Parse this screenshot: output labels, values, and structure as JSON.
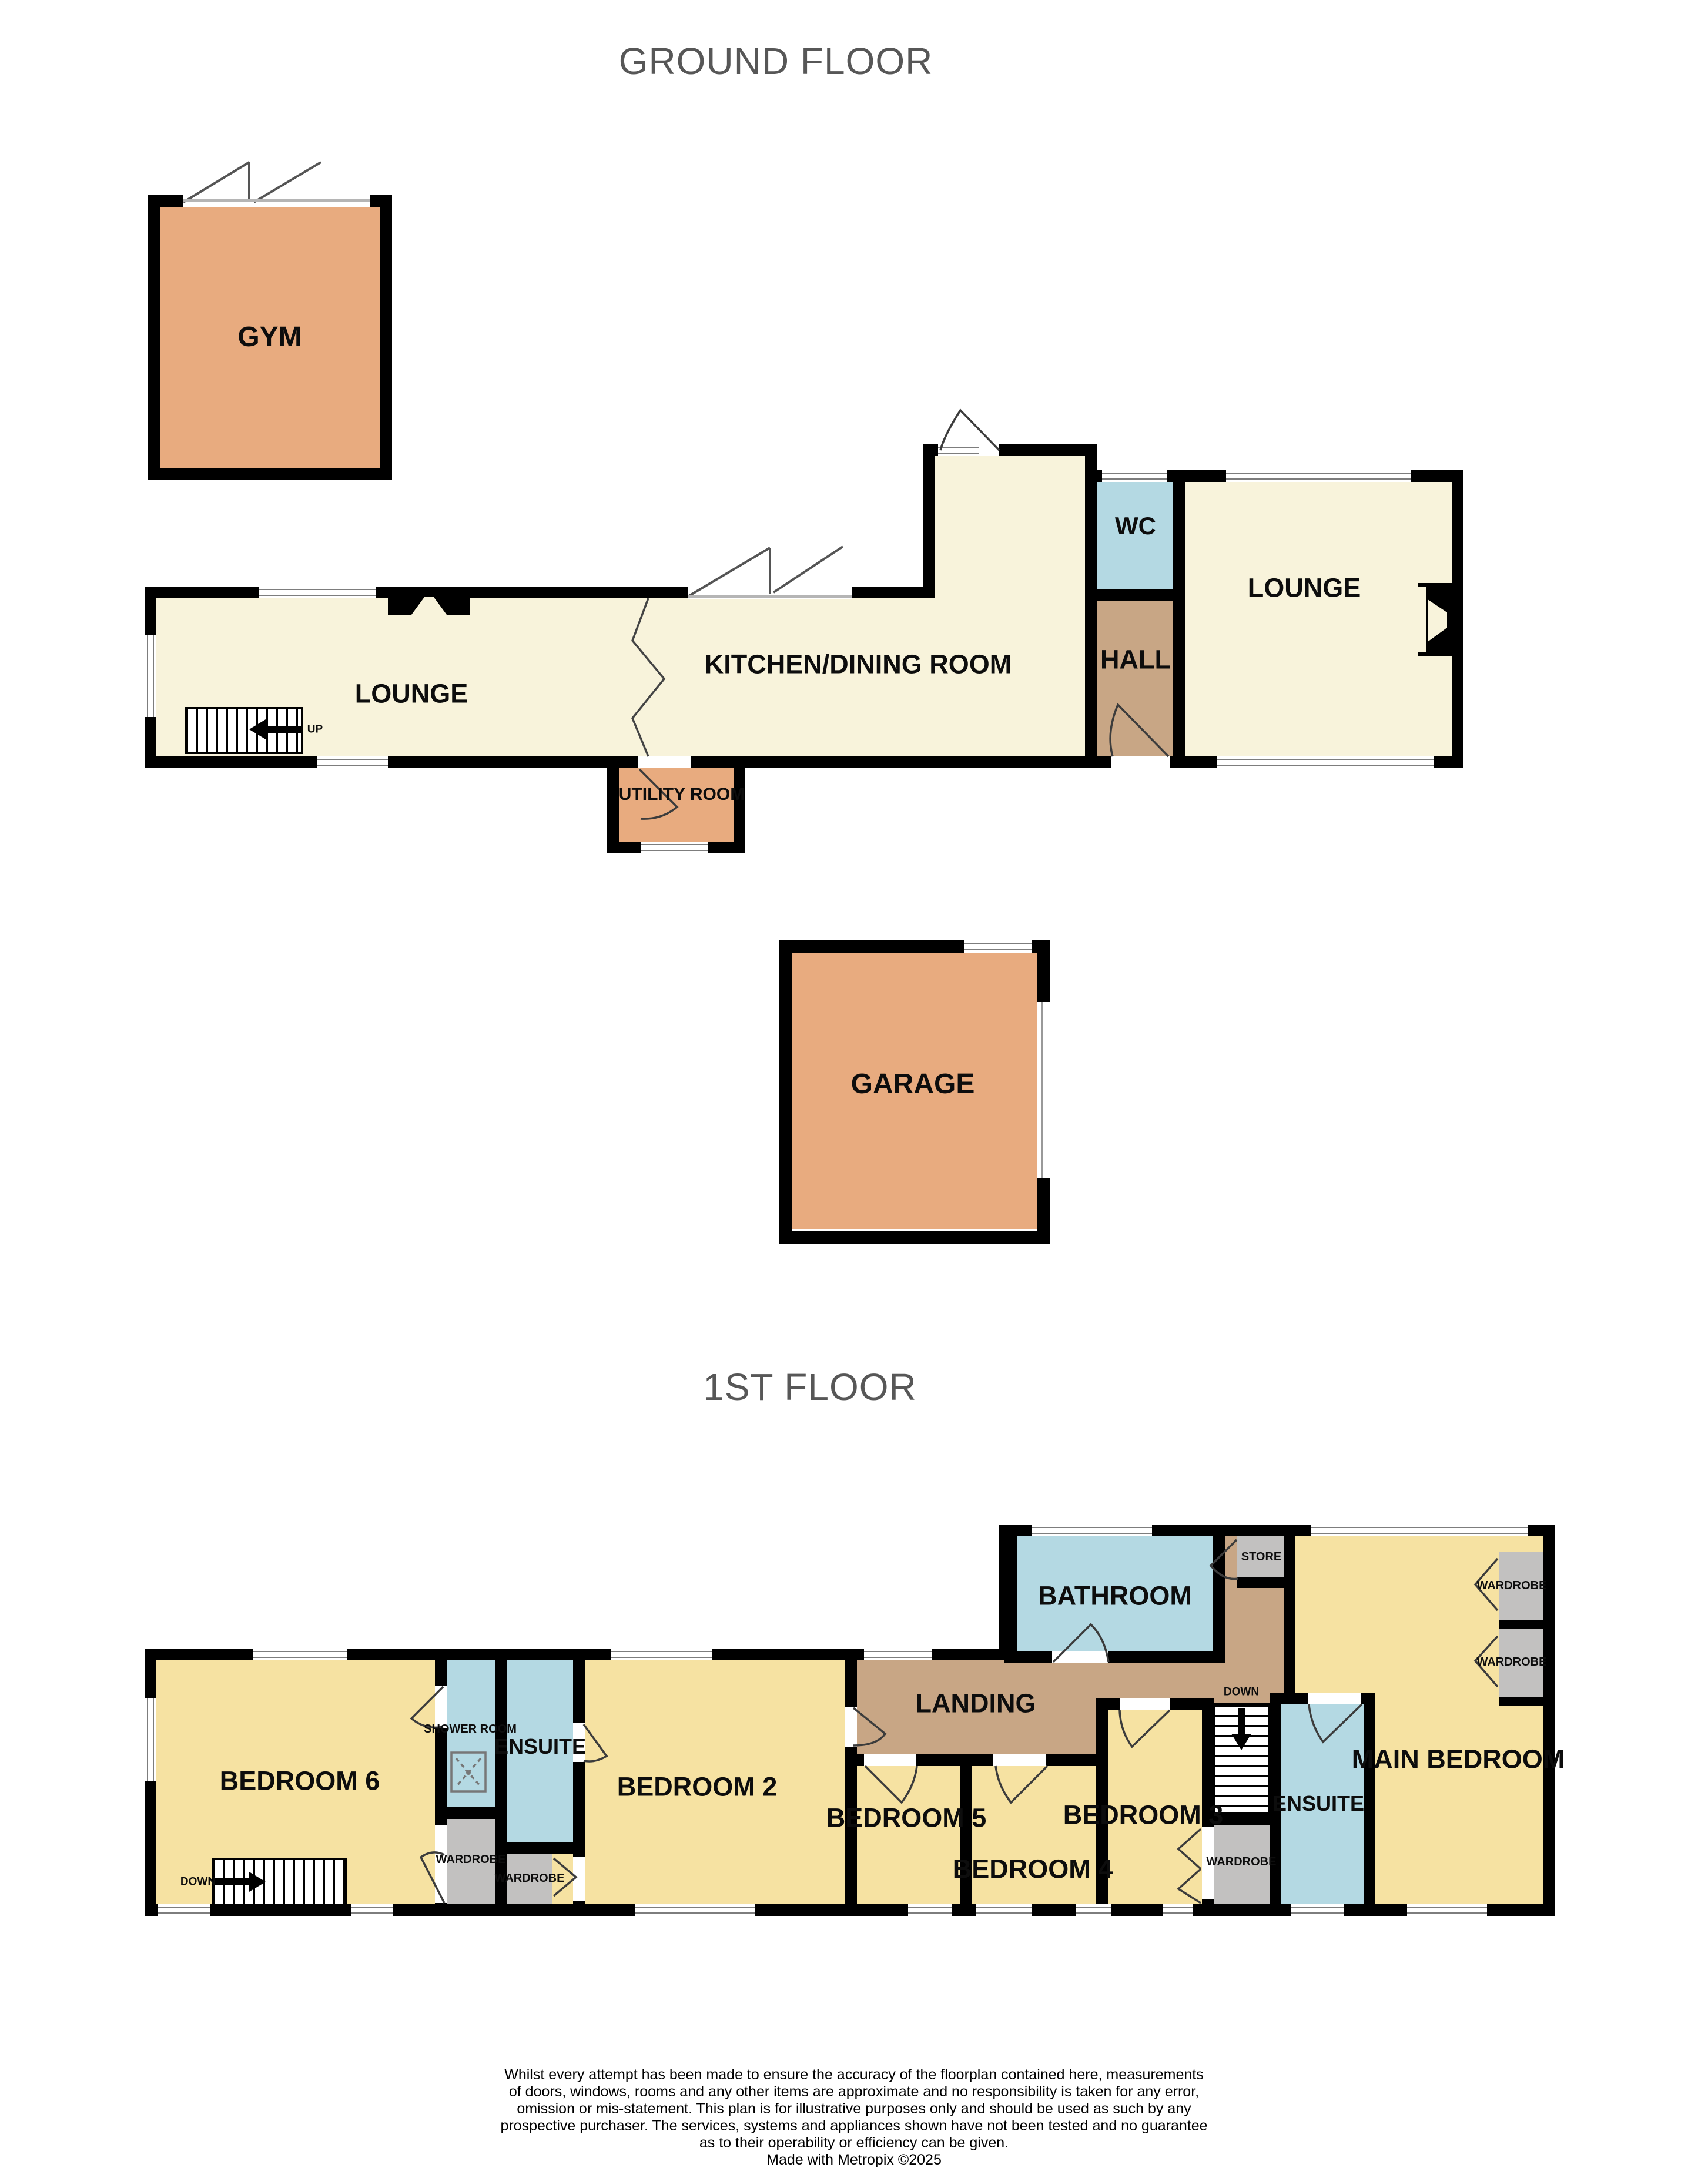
{
  "titles": {
    "ground_floor": "GROUND FLOOR",
    "first_floor": "1ST FLOOR"
  },
  "ground_floor": {
    "gym": "GYM",
    "lounge_left": "LOUNGE",
    "kitchen_dining": "KITCHEN/DINING ROOM",
    "utility": "UTILITY ROOM",
    "hall": "HALL",
    "wc": "WC",
    "lounge_right": "LOUNGE",
    "garage": "GARAGE",
    "stairs_up": "UP"
  },
  "first_floor": {
    "bedroom6": "BEDROOM 6",
    "shower_room": "SHOWER ROOM",
    "ensuite_left": "ENSUITE",
    "bedroom2": "BEDROOM 2",
    "landing": "LANDING",
    "bathroom": "BATHROOM",
    "store": "STORE",
    "bedroom5": "BEDROOM 5",
    "bedroom4": "BEDROOM 4",
    "bedroom3": "BEDROOM 3",
    "ensuite_right": "ENSUITE",
    "main_bedroom": "MAIN BEDROOM",
    "wardrobe": "WARDROBE",
    "stairs_down": "DOWN",
    "landing_down": "DOWN"
  },
  "footer": {
    "disclaimer_lines": [
      "Whilst every attempt has been made to ensure the accuracy of the floorplan contained here, measurements",
      "of doors, windows, rooms and any other items are approximate and no responsibility is taken for any error,",
      "omission or mis-statement. This plan is for illustrative purposes only and should be used as such by any",
      "prospective purchaser. The services, systems and appliances shown have not been tested and no guarantee",
      "as to their operability or efficiency can be given."
    ],
    "credit": "Made with Metropix ©2025"
  },
  "colors": {
    "room_cream": "#F8F3DB",
    "room_orange": "#E8AB7F",
    "room_yellow": "#F6E2A2",
    "room_tan": "#C8A685",
    "room_blue": "#B4D9E3",
    "room_gray": "#C2C1C0",
    "wall": "#000000",
    "title_gray": "#575757"
  }
}
